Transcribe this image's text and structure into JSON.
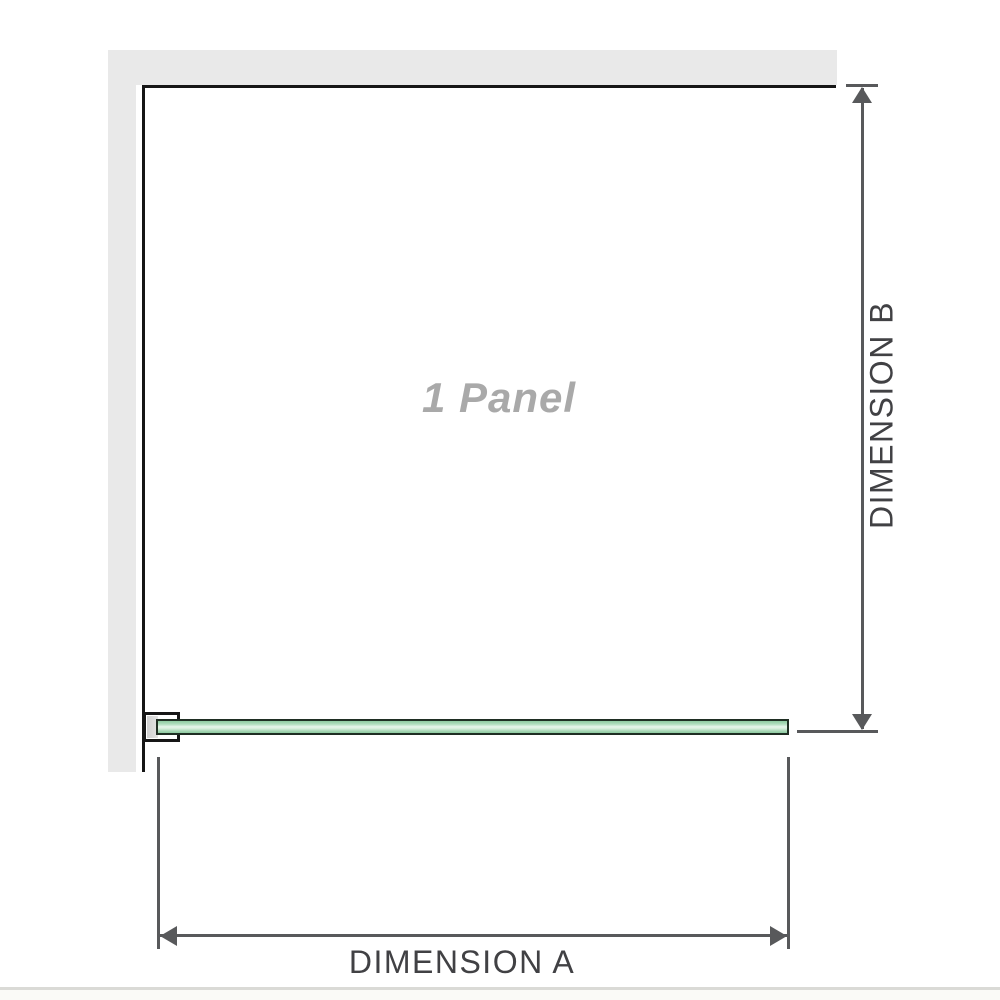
{
  "diagram": {
    "panel_label": "1 Panel",
    "dimensions": {
      "a": {
        "label": "DIMENSION A",
        "orientation": "horizontal"
      },
      "b": {
        "label": "DIMENSION B",
        "orientation": "vertical"
      }
    },
    "colors": {
      "wall": "#e9e9e9",
      "outline": "#161616",
      "dimension": "#58595b",
      "label_text": "#414144",
      "panel_text": "#a9a9a9",
      "glass_dark": "#1f2e23",
      "glass_mid": "#8ecaa0",
      "glass_light": "#e6f4ea",
      "bracket_shade": "#cfcfcf",
      "bottom_rule": "#dadad6"
    }
  }
}
